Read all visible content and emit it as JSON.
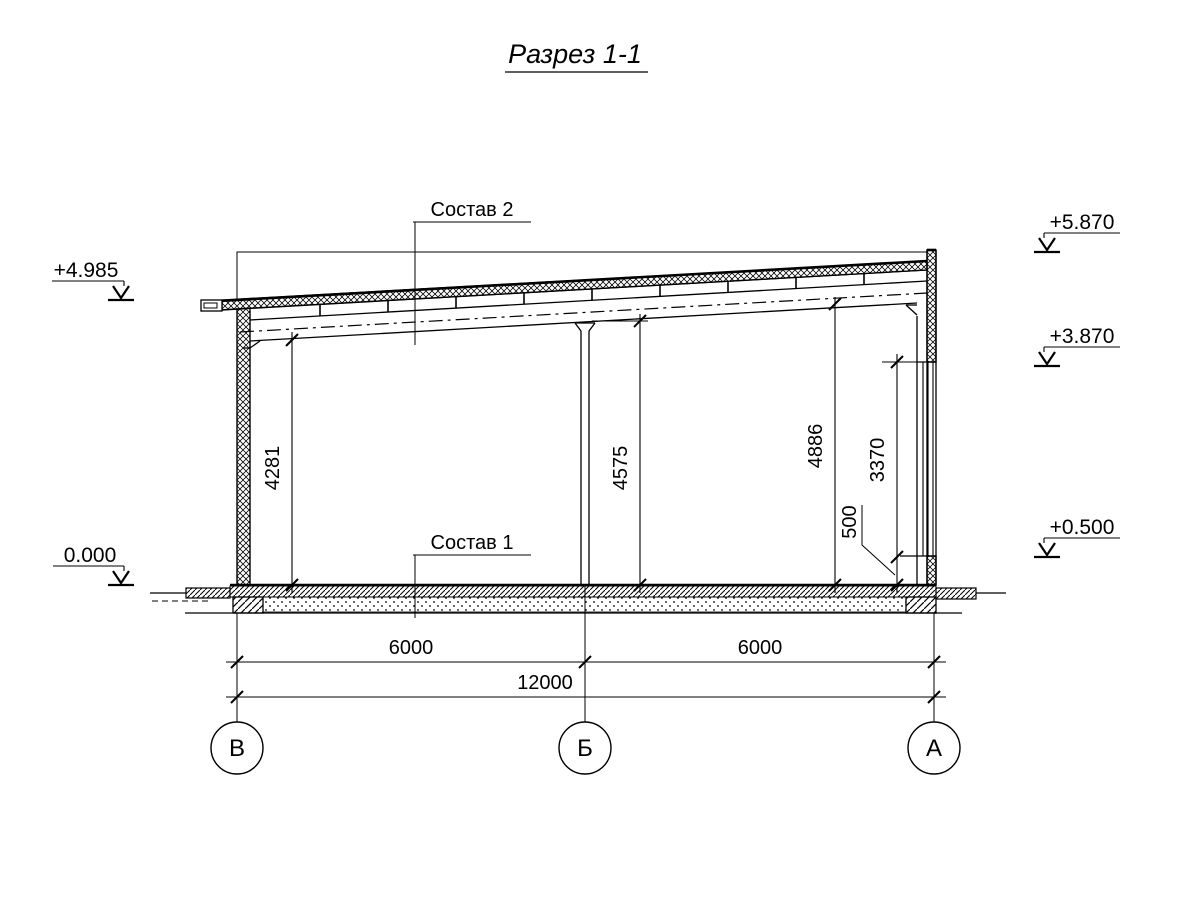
{
  "title": "Разрез 1-1",
  "labels": {
    "roof_composition": "Состав 2",
    "floor_composition": "Состав 1"
  },
  "elevations": {
    "left_eave": "+4.985",
    "left_floor": "0.000",
    "right_parapet": "+5.870",
    "right_window_head": "+3.870",
    "right_sill": "+0.500"
  },
  "dimensions": {
    "interior_height_left": "4281",
    "interior_height_center": "4575",
    "interior_height_right": "4886",
    "window_height": "3370",
    "sill_height": "500",
    "bay_left": "6000",
    "bay_right": "6000",
    "overall_span": "12000"
  },
  "axes": [
    {
      "label": "В"
    },
    {
      "label": "Б"
    },
    {
      "label": "А"
    }
  ]
}
